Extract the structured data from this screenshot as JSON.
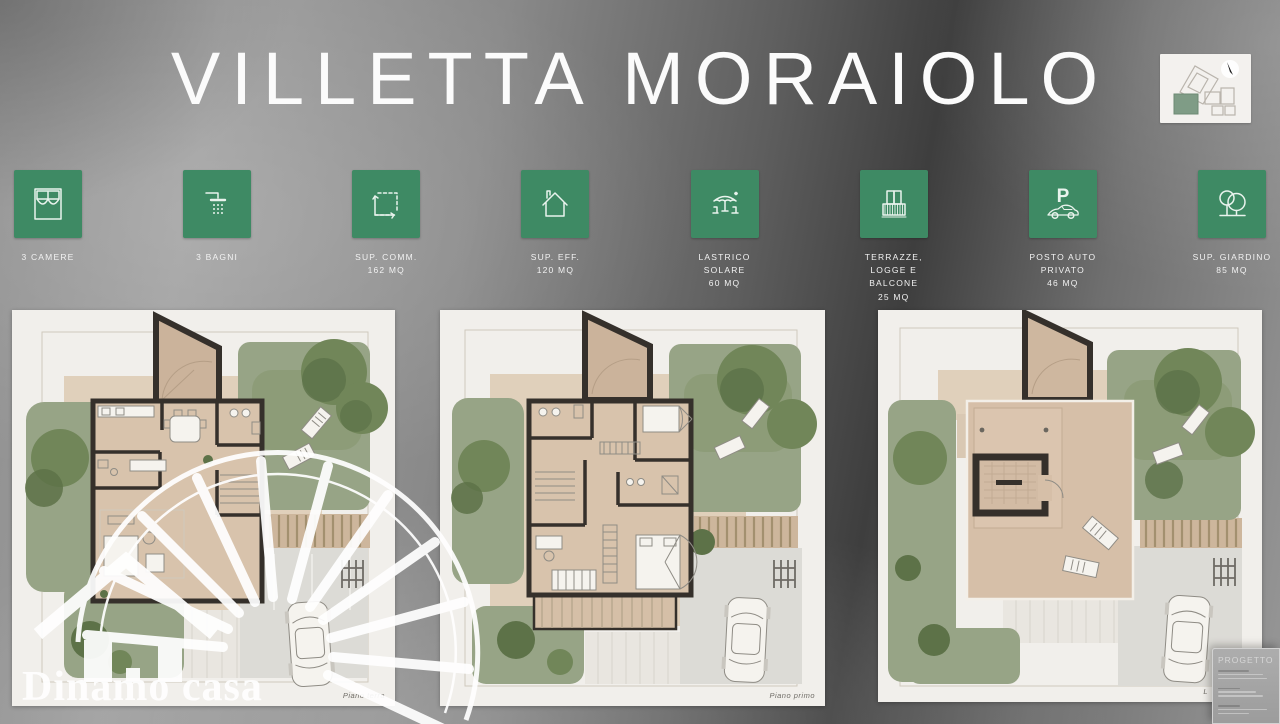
{
  "header": {
    "title": "VILLETTA MORAIOLO"
  },
  "brand": {
    "watermark_text": "Dinamo casa"
  },
  "features": [
    {
      "icon": "bed-icon",
      "label": "3 CAMERE"
    },
    {
      "icon": "shower-icon",
      "label": "3 BAGNI"
    },
    {
      "icon": "area-dimension-icon",
      "label": "SUP. COMM.\n162 MQ"
    },
    {
      "icon": "house-icon",
      "label": "SUP. EFF.\n120 MQ"
    },
    {
      "icon": "patio-umbrella-icon",
      "label": "LASTRICO\nSOLARE\n60 MQ"
    },
    {
      "icon": "balcony-icon",
      "label": "TERRAZZE,\nLOGGE E\nBALCONE\n25 MQ"
    },
    {
      "icon": "parking-icon",
      "label": "POSTO AUTO\nPRIVATO\n46 MQ"
    },
    {
      "icon": "garden-trees-icon",
      "label": "SUP. GIARDINO\n85 MQ"
    }
  ],
  "plans": [
    {
      "name": "ground-floor-plan",
      "caption": "Piano terra"
    },
    {
      "name": "first-floor-plan",
      "caption": "Piano primo"
    },
    {
      "name": "roof-terrace-plan",
      "caption": "L"
    }
  ],
  "progetto": {
    "title": "PROGETTO"
  },
  "colors": {
    "feature_green": "#3e8a64",
    "title_white": "#fbfbfb"
  }
}
